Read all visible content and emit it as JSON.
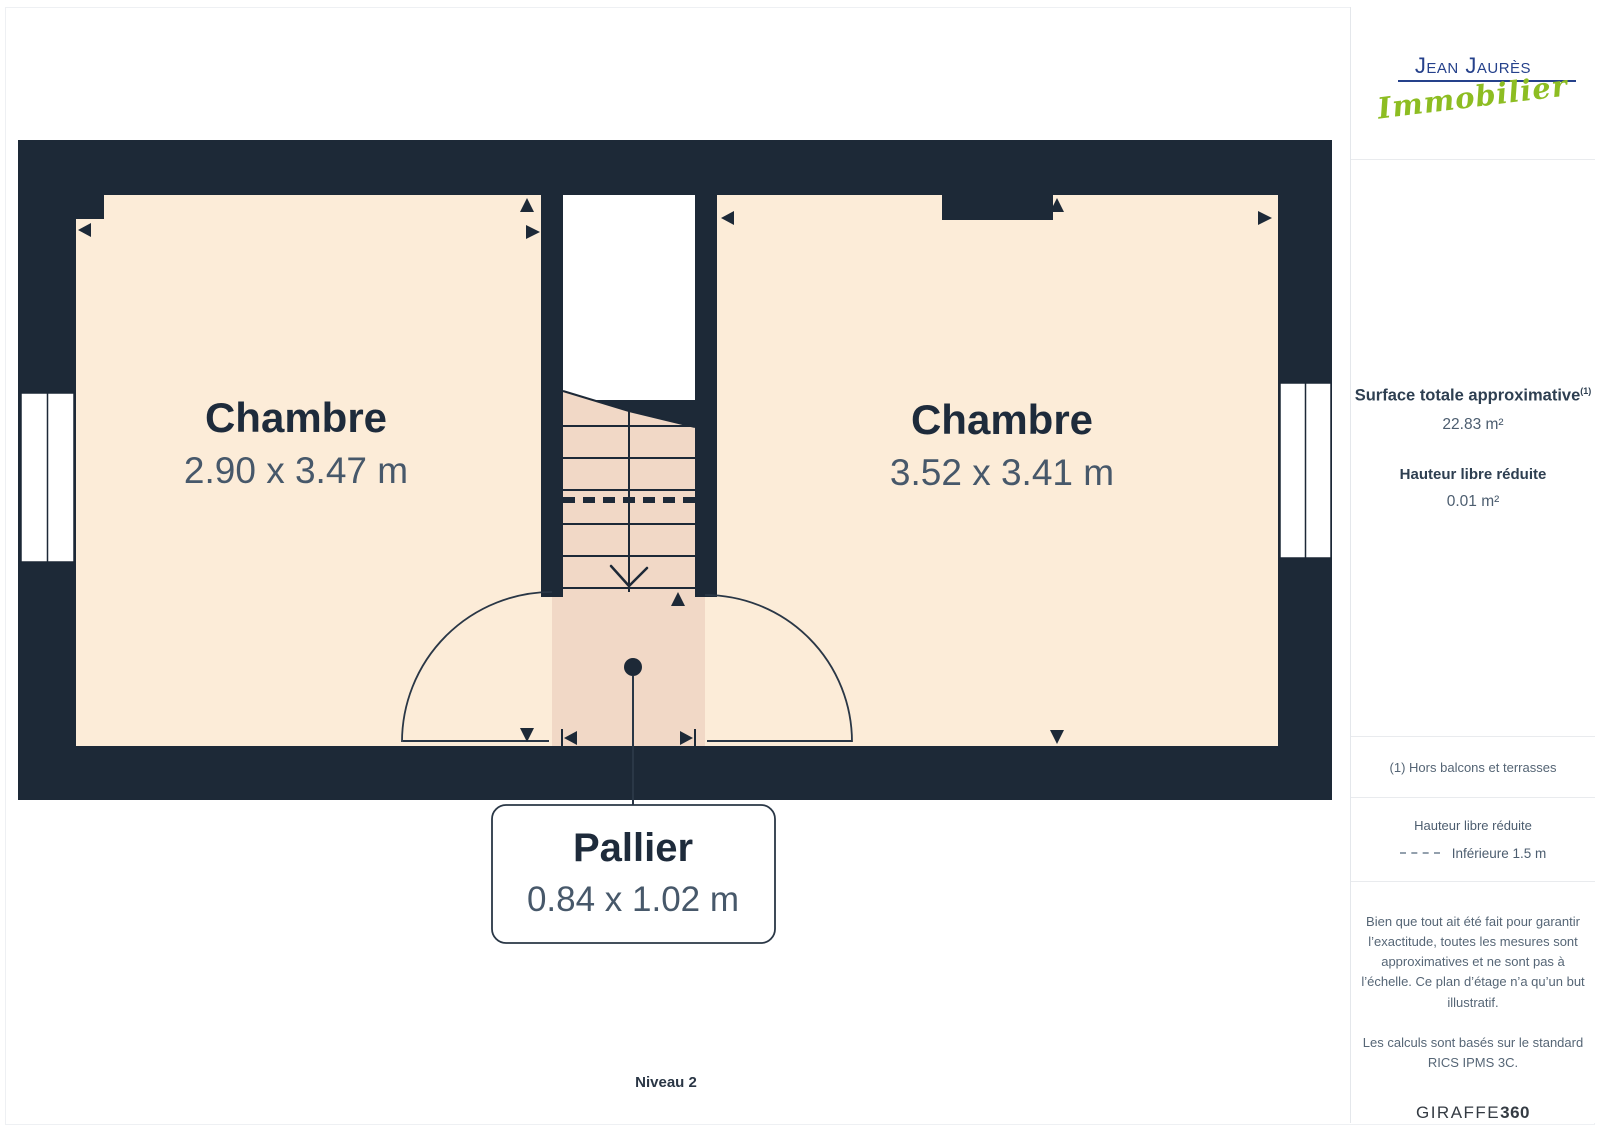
{
  "plan": {
    "level_label": "Niveau 2",
    "rooms": [
      {
        "name": "Chambre",
        "dims": "2.90 x 3.47 m"
      },
      {
        "name": "Chambre",
        "dims": "3.52 x 3.41 m"
      }
    ],
    "landing": {
      "name": "Pallier",
      "dims": "0.84 x 1.02 m"
    }
  },
  "sidebar": {
    "logo": {
      "line1": "Jean Jaurès",
      "line2": "Immobilier"
    },
    "surface": {
      "label": "Surface totale approximative",
      "sup": "(1)",
      "value": "22.83 m²"
    },
    "height": {
      "label": "Hauteur libre réduite",
      "value": "0.01 m²"
    },
    "footnote": "(1) Hors balcons et terrasses",
    "legend": {
      "title": "Hauteur libre réduite",
      "dash_label": "Inférieure 1.5 m"
    },
    "disclaimer": "Bien que tout ait été fait pour garantir l’exactitude, toutes les mesures sont approximatives et ne sont pas à l’échelle. Ce plan d’étage n’a qu’un but illustratif.",
    "standard": "Les calculs sont basés sur le standard RICS IPMS 3C.",
    "brand": {
      "name": "GIRAFFE",
      "suffix": "360"
    }
  },
  "colors": {
    "wall": "#1d2937",
    "room_fill": "#fcecd8",
    "stair_fill": "#f1d8c6",
    "logo_blue": "#25418b",
    "logo_green": "#8dbd22",
    "text_dark": "#1e2b3b",
    "text_dim": "#47586a"
  }
}
